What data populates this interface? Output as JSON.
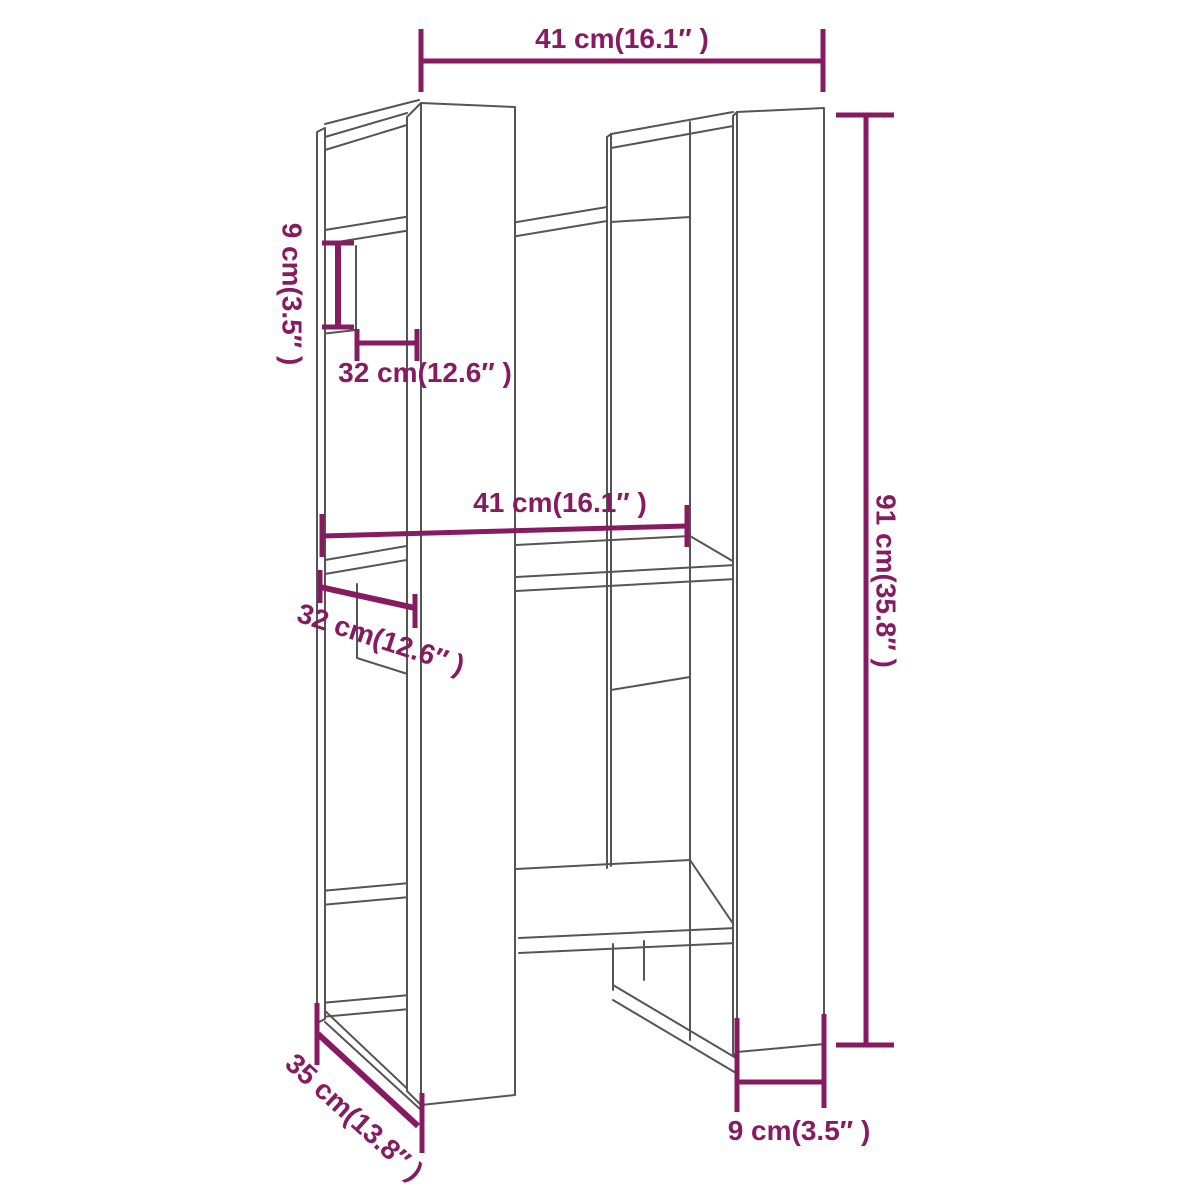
{
  "drawing": {
    "kind": "furniture dimension diagram",
    "subject": "book cabinet / room divider line drawing",
    "colors": {
      "dimension_accent": "#871b61",
      "furniture_outline": "#555555",
      "background": "#ffffff"
    },
    "labels": {
      "top_width": "41 cm(16.1″ )",
      "left_back_height": "9 cm(3.5″ )",
      "upper_shelf_depth": "32 cm(12.6″ )",
      "middle_width": "41 cm(16.1″ )",
      "middle_shelf_depth": "32 cm(12.6″ )",
      "total_height": "91 cm(35.8″ )",
      "base_depth": "35 cm(13.8″ )",
      "right_foot_width": "9 cm(3.5″ )"
    }
  }
}
